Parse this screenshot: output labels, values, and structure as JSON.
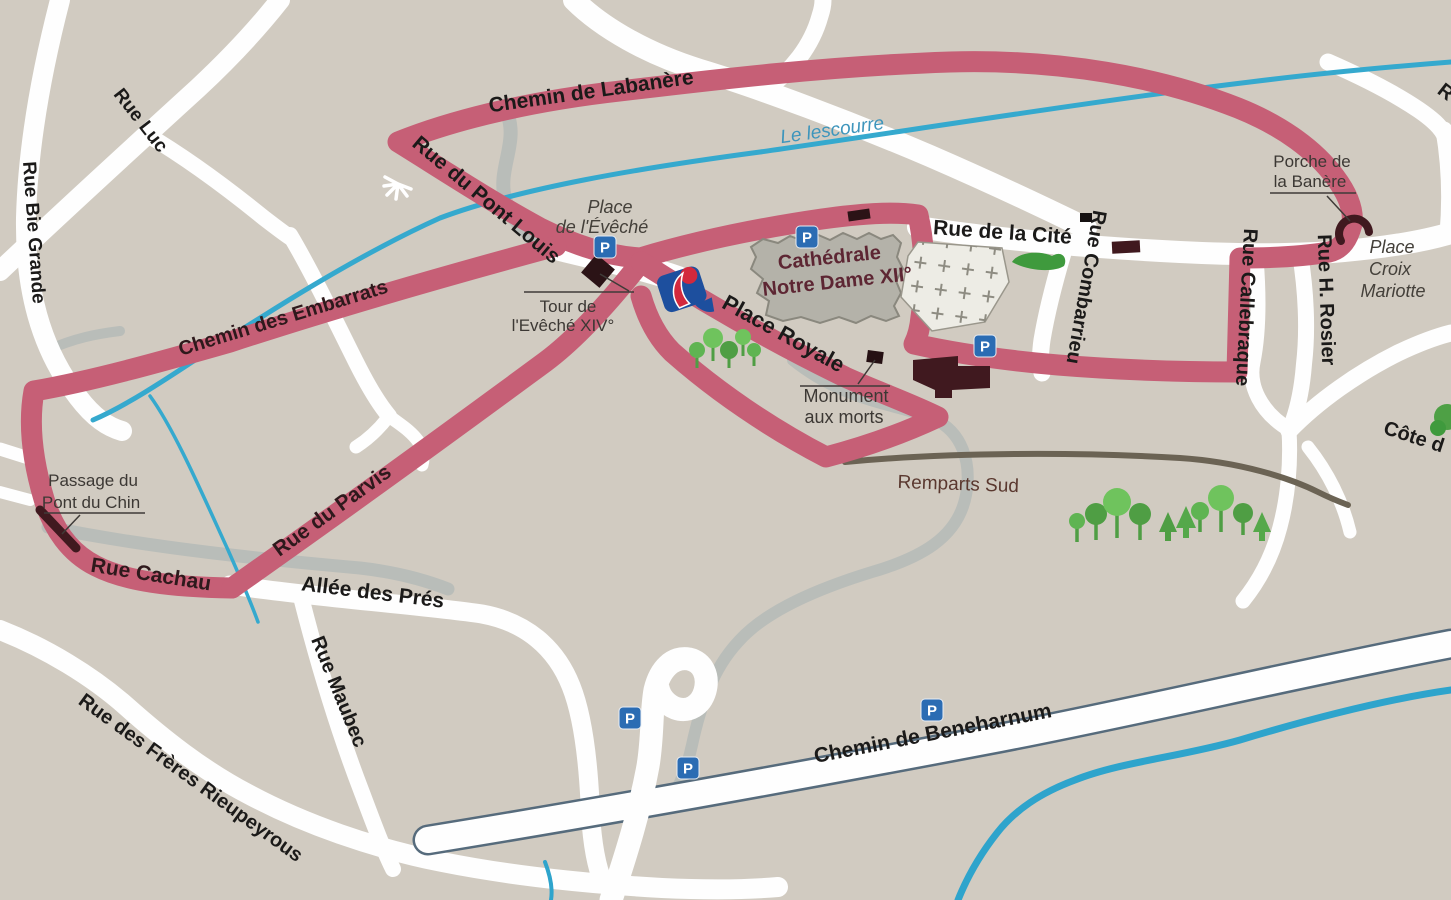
{
  "map": {
    "type": "town-walking-map",
    "route_description": "pink pedestrian circuit"
  },
  "colors": {
    "background": "#d1cbc1",
    "road_white": "#fefefe",
    "route_pink": "#c65f76",
    "river_blue": "#35a9ce",
    "gray_road": "#b9bdb9",
    "dark_building": "#40191f",
    "cathedral_fill": "#b4b2a9",
    "tree_green": "#6fc35d",
    "parking_blue": "#2b6cb3",
    "remparts_line": "#6b6354"
  },
  "parking": {
    "label": "P"
  },
  "labels": {
    "chemin_labanere": "Chemin de Labanère",
    "rue_pont_louis": "Rue du Pont Louis",
    "le_lescourre": "Le lescourre",
    "rue_luc": "Rue Luc",
    "rue_bie_grande": "Rue Bie Grande",
    "chemin_embarrats": "Chemin des Embarrats",
    "place_eveche_1": "Place",
    "place_eveche_2": "de l'Évêché",
    "tour_1": "Tour de",
    "tour_2": "l'Evêché XIV°",
    "cathedrale_1": "Cathédrale",
    "cathedrale_2": "Notre Dame XII°",
    "rue_cite": "Rue de la Cité",
    "rue_combarrieu": "Rue Combarrieu",
    "rue_callebraque": "Rue Callebraque",
    "rue_rosier": "Rue H. Rosier",
    "porche_1": "Porche de",
    "porche_2": "la Banère",
    "croix_1": "Place",
    "croix_2": "Croix",
    "croix_3": "Mariotte",
    "place_royale": "Place Royale",
    "monument_1": "Monument",
    "monument_2": "aux morts",
    "remparts_sud": "Remparts Sud",
    "passage_1": "Passage du",
    "passage_2": "Pont du Chin",
    "rue_cachau": "Rue Cachau",
    "allee_pres": "Allée des Prés",
    "rue_maubec": "Rue Maubec",
    "rieupeyrous": "Rue des Frères Rieupeyrous",
    "beneharnum": "Chemin de Beneharnum",
    "rue_parvis": "Rue du Parvis",
    "cote_d": "Côte d",
    "r_partial": "R"
  }
}
